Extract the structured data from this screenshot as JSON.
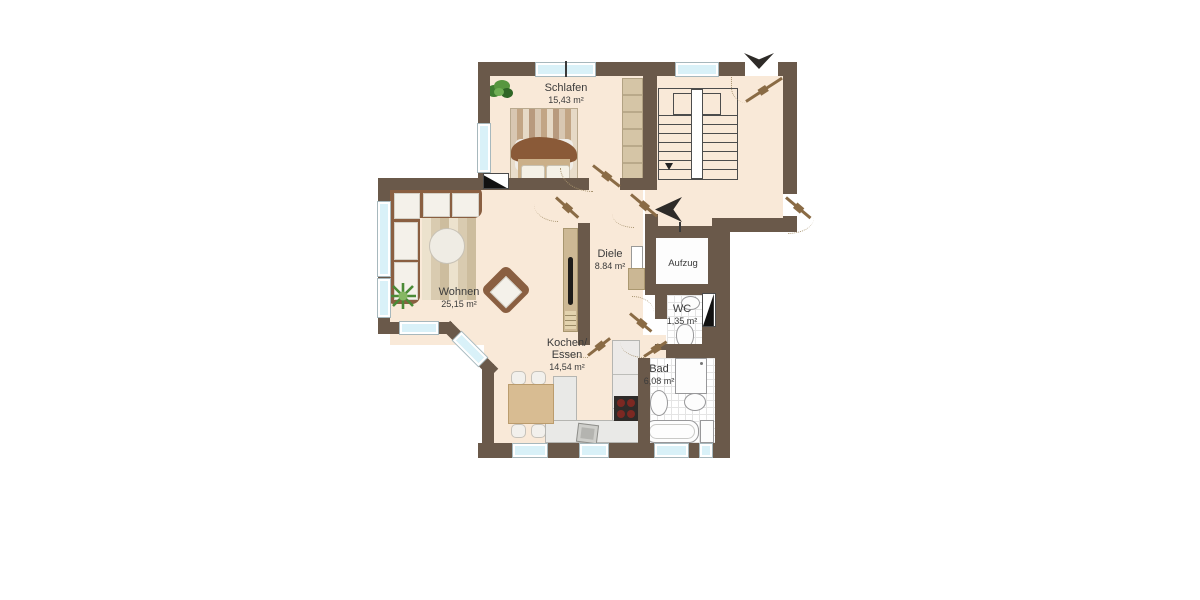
{
  "floorplan": {
    "rooms": [
      {
        "name": "Schlafen",
        "area": "15,43 m²"
      },
      {
        "name": "Wohnen",
        "area": "25,15 m²"
      },
      {
        "name": "Diele",
        "area": "8.84 m²"
      },
      {
        "name": "Kochen/",
        "name2": "Essen",
        "area": "14,54 m²"
      },
      {
        "name": "WC",
        "area": "1,35 m²"
      },
      {
        "name": "Bad",
        "area": "6,08 m²"
      },
      {
        "name": "Aufzug"
      }
    ],
    "elements": [
      "staircase",
      "elevator",
      "bed",
      "wardrobe",
      "corner-sofa",
      "coffee-table",
      "armchair",
      "tv-sideboard",
      "dining-table",
      "kitchen-counter",
      "stove",
      "kitchen-sink",
      "bathtub",
      "shower",
      "toilet",
      "washbasin",
      "washing-machine",
      "plant",
      "chimney",
      "entrance-arrow"
    ],
    "colors": {
      "wall": "#6a594a",
      "floor": "#f9e9d8",
      "window_glass": "#d9f1f8",
      "door_leaf": "#8a6b45",
      "tile": "#ffffff",
      "arrow": "#2e2b28"
    }
  }
}
